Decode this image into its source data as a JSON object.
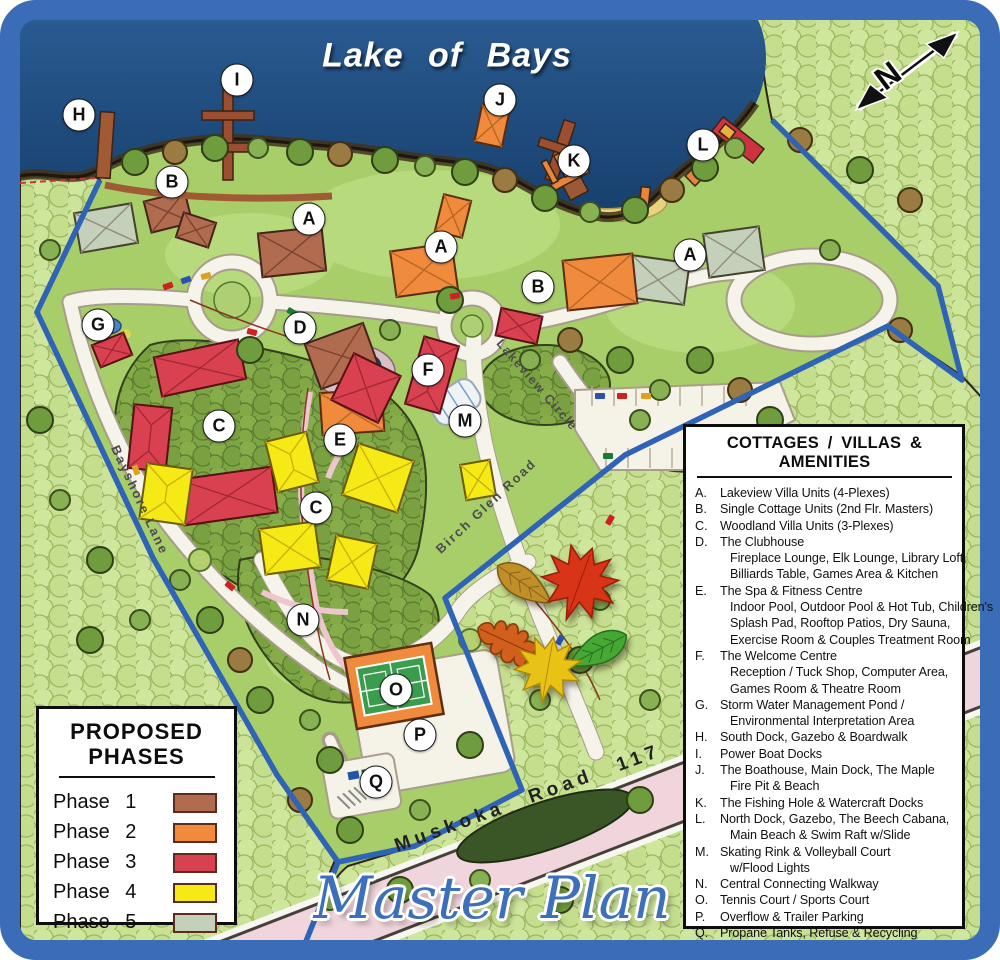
{
  "titles": {
    "lake": "Lake of Bays",
    "master_plan": "Master Plan"
  },
  "compass": {
    "label": "N"
  },
  "roads": {
    "muskoka": "Muskoka Road 117",
    "bayshore": "Bayshore Lane",
    "birch_glen": "Birch Glen Road",
    "lakeview": "Lakeview Circle"
  },
  "markers": [
    {
      "letter": "H",
      "x": 79,
      "y": 115
    },
    {
      "letter": "I",
      "x": 237,
      "y": 80
    },
    {
      "letter": "J",
      "x": 500,
      "y": 100
    },
    {
      "letter": "K",
      "x": 574,
      "y": 161
    },
    {
      "letter": "L",
      "x": 703,
      "y": 145
    },
    {
      "letter": "B",
      "x": 172,
      "y": 182
    },
    {
      "letter": "A",
      "x": 309,
      "y": 219
    },
    {
      "letter": "A",
      "x": 441,
      "y": 247
    },
    {
      "letter": "B",
      "x": 538,
      "y": 287
    },
    {
      "letter": "A",
      "x": 690,
      "y": 255
    },
    {
      "letter": "G",
      "x": 98,
      "y": 325
    },
    {
      "letter": "D",
      "x": 300,
      "y": 328
    },
    {
      "letter": "F",
      "x": 428,
      "y": 370
    },
    {
      "letter": "M",
      "x": 465,
      "y": 421
    },
    {
      "letter": "C",
      "x": 219,
      "y": 426
    },
    {
      "letter": "E",
      "x": 340,
      "y": 440
    },
    {
      "letter": "C",
      "x": 316,
      "y": 508
    },
    {
      "letter": "N",
      "x": 303,
      "y": 620
    },
    {
      "letter": "O",
      "x": 396,
      "y": 690
    },
    {
      "letter": "P",
      "x": 420,
      "y": 735
    },
    {
      "letter": "Q",
      "x": 376,
      "y": 782
    }
  ],
  "amenities": {
    "title": "COTTAGES / VILLAS & AMENITIES",
    "items": [
      {
        "id": "A.",
        "text": "Lakeview Villa Units (4-Plexes)"
      },
      {
        "id": "B.",
        "text": "Single Cottage Units (2nd Flr. Masters)"
      },
      {
        "id": "C.",
        "text": "Woodland Villa Units (3-Plexes)"
      },
      {
        "id": "D.",
        "text": "The Clubhouse",
        "sub": [
          "Fireplace Lounge, Elk Lounge, Library Loft,",
          "Billiards Table, Games Area & Kitchen"
        ]
      },
      {
        "id": "E.",
        "text": "The Spa & Fitness Centre",
        "sub": [
          "Indoor Pool, Outdoor Pool & Hot Tub, Children's",
          "Splash Pad, Rooftop Patios, Dry Sauna,",
          "Exercise Room & Couples Treatment Room"
        ]
      },
      {
        "id": "F.",
        "text": "The Welcome Centre",
        "sub": [
          "Reception / Tuck Shop, Computer Area,",
          "Games Room & Theatre Room"
        ]
      },
      {
        "id": "G.",
        "text": "Storm Water Management Pond /",
        "sub": [
          "Environmental Interpretation Area"
        ]
      },
      {
        "id": "H.",
        "text": "South Dock, Gazebo & Boardwalk"
      },
      {
        "id": "I.",
        "text": "Power Boat Docks"
      },
      {
        "id": "J.",
        "text": "The Boathouse, Main Dock, The Maple",
        "sub": [
          "Fire Pit & Beach"
        ]
      },
      {
        "id": "K.",
        "text": "The Fishing Hole & Watercraft Docks"
      },
      {
        "id": "L.",
        "text": "North Dock, Gazebo, The Beech Cabana,",
        "sub": [
          "Main Beach & Swim Raft w/Slide"
        ]
      },
      {
        "id": "M.",
        "text": "Skating Rink & Volleyball Court",
        "sub": [
          "w/Flood Lights"
        ]
      },
      {
        "id": "N.",
        "text": "Central Connecting Walkway"
      },
      {
        "id": "O.",
        "text": "Tennis Court / Sports Court"
      },
      {
        "id": "P.",
        "text": "Overflow & Trailer Parking"
      },
      {
        "id": "Q.",
        "text": "Propane Tanks, Refuse & Recycling"
      }
    ]
  },
  "phases": {
    "title_line1": "PROPOSED",
    "title_line2": "PHASES",
    "items": [
      {
        "label": "Phase 1",
        "color": "#b16c50"
      },
      {
        "label": "Phase 2",
        "color": "#f08a3c"
      },
      {
        "label": "Phase 3",
        "color": "#da4150"
      },
      {
        "label": "Phase 4",
        "color": "#f6ea16"
      },
      {
        "label": "Phase 5",
        "color": "#c5d0bb"
      }
    ]
  },
  "colors": {
    "frame_blue": "#3b6cb8",
    "lake_blue": "#1d4a7c",
    "land_green": "#a8ce69",
    "boundary_blue": "#2f63b6",
    "road_pink": "#f0d6dc"
  }
}
